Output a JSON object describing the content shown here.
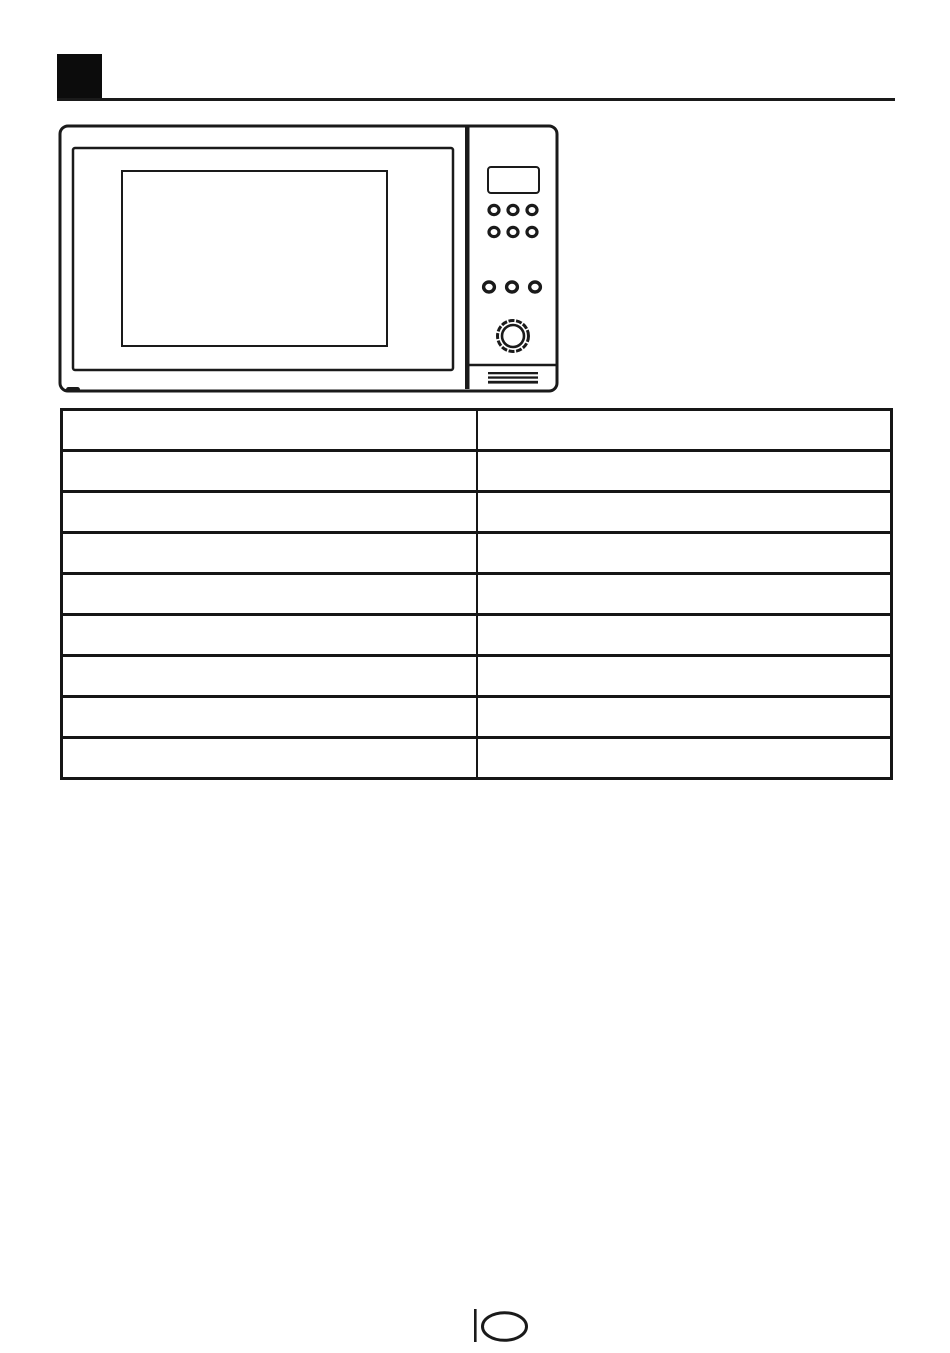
{
  "page": {
    "background": "#ffffff",
    "ink_color": "#1a1a1a"
  },
  "header": {
    "section_marker_icon": "black-square",
    "rule": "horizontal-divider"
  },
  "figure": {
    "icon": "microwave-oven-front-illustration",
    "parts": [
      "oven-body",
      "door-frame",
      "door-window",
      "control-panel-divider",
      "display",
      "button-row-1",
      "button-row-2",
      "button-row-3",
      "rotary-knob",
      "panel-bottom-separator",
      "vent-grille",
      "foot"
    ]
  },
  "table": {
    "columns": 2,
    "rows": [
      [
        "",
        ""
      ],
      [
        "",
        ""
      ],
      [
        "",
        ""
      ],
      [
        "",
        ""
      ],
      [
        "",
        ""
      ],
      [
        "",
        ""
      ],
      [
        "",
        ""
      ],
      [
        "",
        ""
      ],
      [
        "",
        ""
      ]
    ]
  },
  "footer": {
    "page_number": "10"
  }
}
